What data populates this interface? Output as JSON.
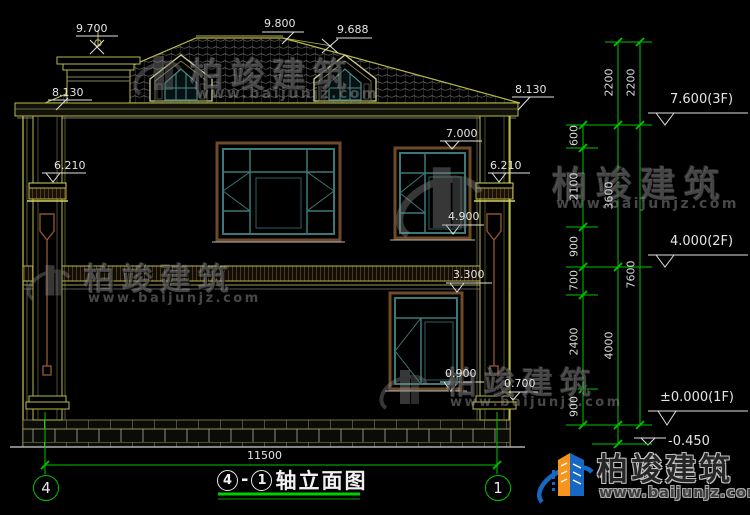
{
  "drawing": {
    "title": {
      "left_axis": "4",
      "separator": "-",
      "right_axis": "1",
      "name": "轴立面图"
    },
    "elevation_labels": {
      "l9700": "9.700",
      "l9800": "9.800",
      "l9688": "9.688",
      "l8130_left": "8.130",
      "l8130_right": "8.130",
      "l7000": "7.000",
      "l6210_left": "6.210",
      "l6210_right": "6.210",
      "l4900": "4.900",
      "l3300": "3.300",
      "l0900": "0.900",
      "l0700": "0.700",
      "l7600_3f": "7.600(3F)",
      "l4000_2f": "4.000(2F)",
      "l0000_1f": "±0.000(1F)",
      "lneg0450": "-0.450"
    },
    "dimensions": {
      "d600": "600",
      "d2100": "2100",
      "d900_upper": "900",
      "d700": "700",
      "d2400": "2400",
      "d900_lower": "900",
      "d2200_inner": "2200",
      "d2200_outer": "2200",
      "d3600": "3600",
      "d4000": "4000",
      "d7600": "7600",
      "d11500": "11500"
    },
    "axis_bubbles": {
      "left": "4",
      "right": "1"
    }
  },
  "watermark": {
    "brand": "柏竣建筑",
    "url": "www.baijunjz.com"
  },
  "logo": {
    "brand": "柏竣建筑",
    "url": "www.baijunjz.com"
  },
  "colors": {
    "background": "#000000",
    "cad_yellow": "#b9b948",
    "cad_green": "#00c400",
    "window_teal": "#3c7878",
    "frame_brown": "#6e4a28",
    "text_white": "#e4e4e4",
    "logo_blue": "#1668c4",
    "logo_orange": "#f7941d"
  }
}
